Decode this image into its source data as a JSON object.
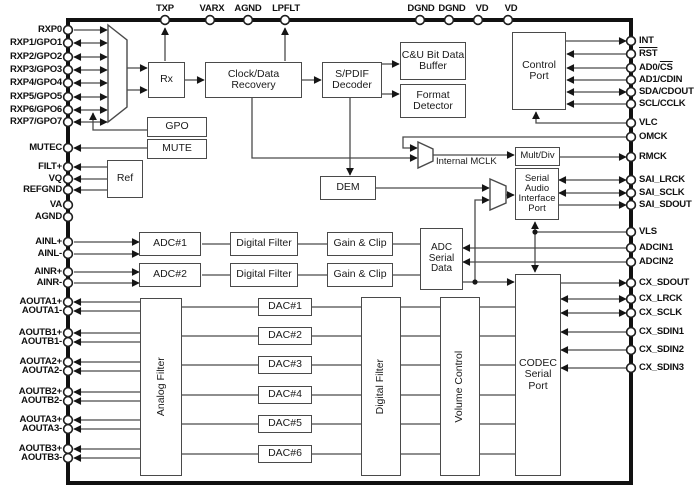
{
  "diagram_type": "audio-codec-block-diagram",
  "colors": {
    "wire": "#4a4a4a",
    "chip_border": "#111111",
    "text": "#1a1a1a",
    "background": "#ffffff"
  },
  "blocks": {
    "rx": "Rx",
    "cdr": "Clock/Data Recovery",
    "spdif": "S/PDIF Decoder",
    "cu": "C&U Bit Data Buffer",
    "fmt": "Format Detector",
    "ctrl": "Control Port",
    "gpo": "GPO",
    "mute": "MUTE",
    "ref": "Ref",
    "dem": "DEM",
    "internal_mclk": "Internal MCLK",
    "multdiv": "Mult/Div",
    "saip": "Serial Audio Interface Port",
    "adc1": "ADC#1",
    "adc2": "ADC#2",
    "df1": "Digital Filter",
    "df2": "Digital Filter",
    "gc1": "Gain & Clip",
    "gc2": "Gain & Clip",
    "asd": "ADC Serial Data",
    "analog_filter": "Analog Filter",
    "dac1": "DAC#1",
    "dac2": "DAC#2",
    "dac3": "DAC#3",
    "dac4": "DAC#4",
    "dac5": "DAC#5",
    "dac6": "DAC#6",
    "dac_digital_filter": "Digital Filter",
    "volume_control": "Volume Control",
    "codec": "CODEC Serial Port"
  },
  "pins": {
    "top": {
      "txp": "TXP",
      "varx": "VARX",
      "agnd1": "AGND",
      "lpflt": "LPFLT",
      "dgnd1": "DGND",
      "dgnd2": "DGND",
      "vd1": "VD",
      "vd2": "VD"
    },
    "left": {
      "rxp0": "RXP0",
      "rxp1": "RXP1/GPO1",
      "rxp2": "RXP2/GPO2",
      "rxp3": "RXP3/GPO3",
      "rxp4": "RXP4/GPO4",
      "rxp5": "RXP5/GPO5",
      "rxp6": "RXP6/GPO6",
      "rxp7": "RXP7/GPO7",
      "mutec": "MUTEC",
      "filt": "FILT+",
      "vq": "VQ",
      "refgnd": "REFGND",
      "va": "VA",
      "agnd2": "AGND",
      "ainlp": "AINL+",
      "ainlm": "AINL-",
      "ainrp": "AINR+",
      "ainrm": "AINR-",
      "aouta1p": "AOUTA1+",
      "aouta1m": "AOUTA1-",
      "aoutb1p": "AOUTB1+",
      "aoutb1m": "AOUTB1-",
      "aouta2p": "AOUTA2+",
      "aouta2m": "AOUTA2-",
      "aoutb2p": "AOUTB2+",
      "aoutb2m": "AOUTB2-",
      "aouta3p": "AOUTA3+",
      "aouta3m": "AOUTA3-",
      "aoutb3p": "AOUTB3+",
      "aoutb3m": "AOUTB3-"
    },
    "right": {
      "int": "INT",
      "rst": "RST",
      "ad0_pre": "AD0/",
      "ad0_over": "CS",
      "ad1": "AD1/CDIN",
      "sda": "SDA/CDOUT",
      "scl": "SCL/CCLK",
      "vlc": "VLC",
      "omck": "OMCK",
      "rmck": "RMCK",
      "sai_lrck": "SAI_LRCK",
      "sai_sclk": "SAI_SCLK",
      "sai_sdout": "SAI_SDOUT",
      "vls": "VLS",
      "adcin1": "ADCIN1",
      "adcin2": "ADCIN2",
      "cx_sdout": "CX_SDOUT",
      "cx_lrck": "CX_LRCK",
      "cx_sclk": "CX_SCLK",
      "cx_sdin1": "CX_SDIN1",
      "cx_sdin2": "CX_SDIN2",
      "cx_sdin3": "CX_SDIN3"
    }
  }
}
